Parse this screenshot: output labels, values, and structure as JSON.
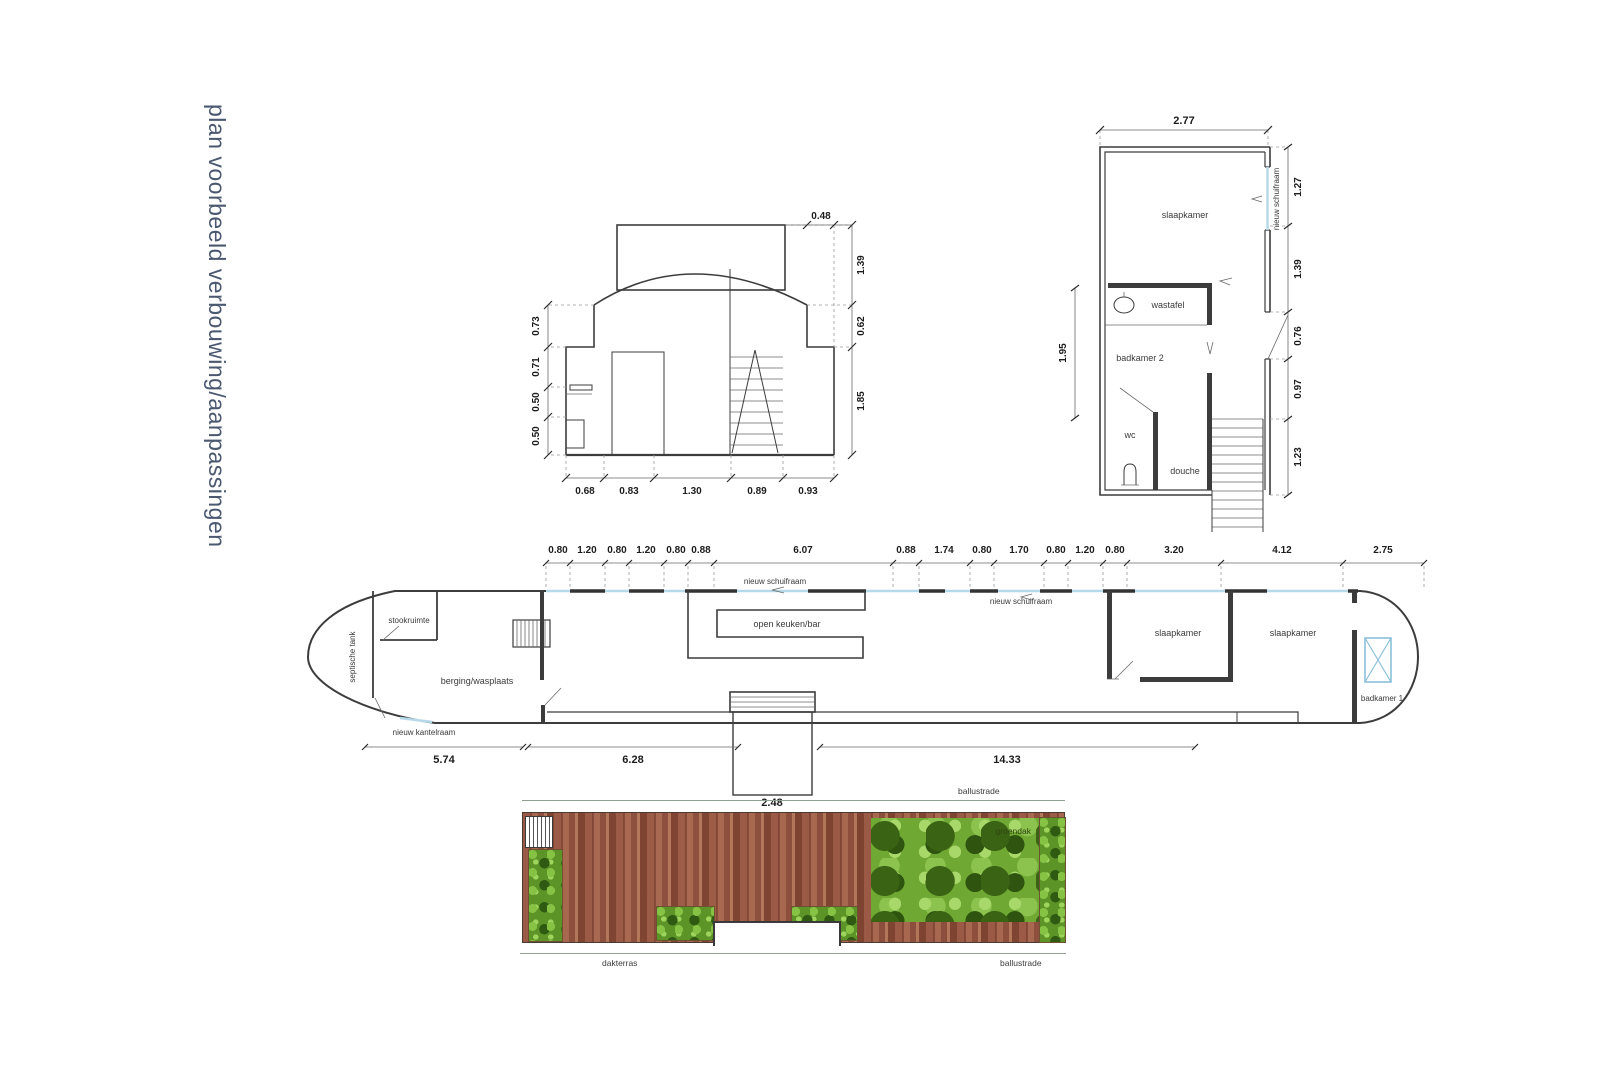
{
  "title": "plan voorbeeld verbouwing/aanpassingen",
  "section_view": {
    "dim_top": "0.48",
    "dims_right": [
      "1.39",
      "0.62",
      "1.85"
    ],
    "dims_left": [
      "0.73",
      "0.71",
      "0.50",
      "0.50"
    ],
    "dims_bottom": [
      "0.68",
      "0.83",
      "1.30",
      "0.89",
      "0.93"
    ]
  },
  "upper_deck_plan": {
    "dim_width": "2.77",
    "dims_right": [
      "1.27",
      "1.39",
      "0.76",
      "0.97",
      "1.23"
    ],
    "dim_left": "1.95",
    "room_slaapkamer": "slaapkamer",
    "room_wastafel": "wastafel",
    "room_badkamer2": "badkamer 2",
    "room_wc": "wc",
    "room_douche": "douche",
    "window_label": "nieuw schuifraam"
  },
  "main_deck_plan": {
    "dims_top": [
      "0.80",
      "1.20",
      "0.80",
      "1.20",
      "0.80",
      "0.88",
      "6.07",
      "0.88",
      "1.74",
      "0.80",
      "1.70",
      "0.80",
      "1.20",
      "0.80",
      "3.20",
      "4.12",
      "2.75"
    ],
    "dims_bottom": [
      "5.74",
      "6.28",
      "14.33"
    ],
    "dim_entrance": "2.48",
    "label_septische_tank": "septische tank",
    "label_stookruimte": "stookruimte",
    "label_berging": "berging/wasplaats",
    "label_kantelraam": "nieuw kantelraam",
    "label_schuifraam_1": "nieuw schuifraam",
    "label_schuifraam_2": "nieuw schuifraam",
    "label_keuken": "open keuken/bar",
    "label_slaapkamer_1": "slaapkamer",
    "label_slaapkamer_2": "slaapkamer",
    "label_badkamer1": "badkamer 1"
  },
  "roof_plan": {
    "label_balustrade_top": "ballustrade",
    "label_balustrade_bottom": "ballustrade",
    "label_dakterras": "dakterras",
    "label_groendak": "groendak"
  },
  "colors": {
    "line": "#3c3c3c",
    "window_blue": "#b6d9e9",
    "title_text": "#4a5870",
    "deck_wood": "#96563f",
    "green": "#5d9428"
  }
}
